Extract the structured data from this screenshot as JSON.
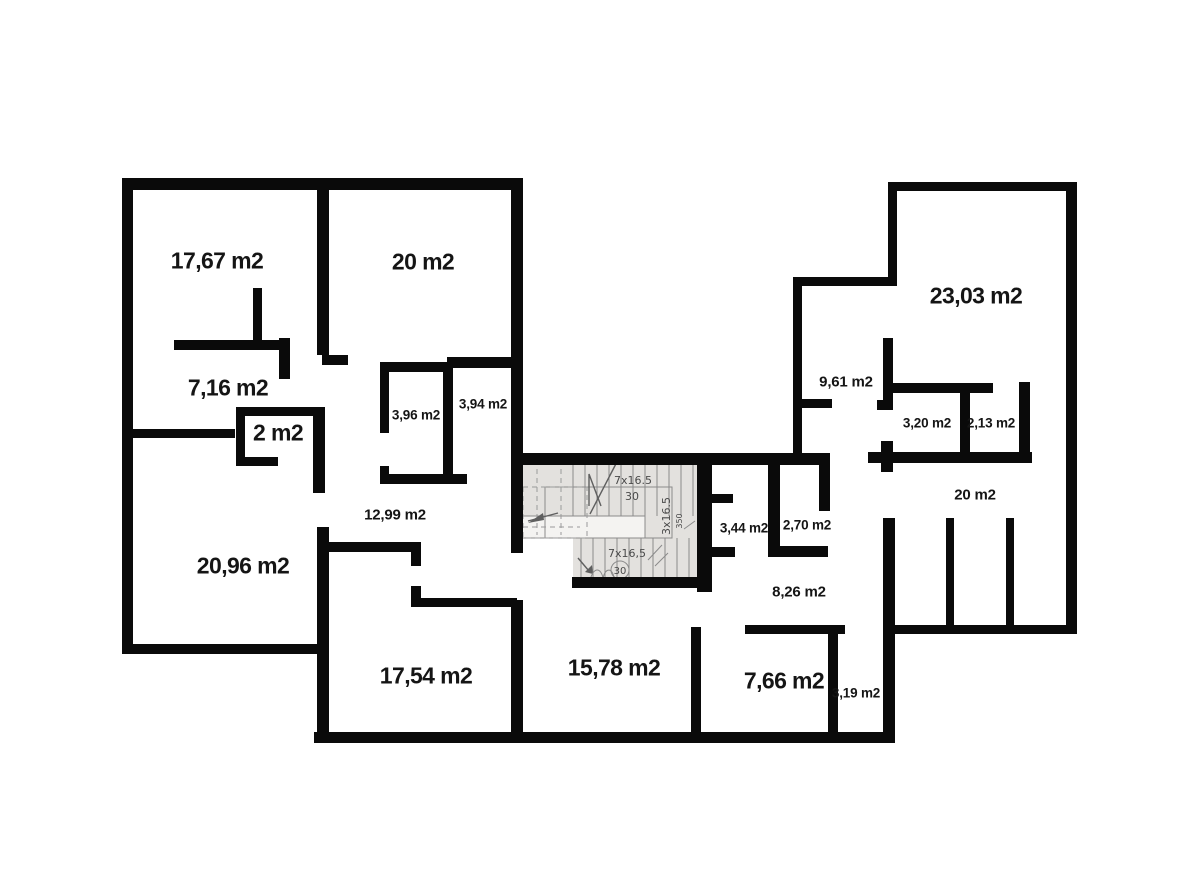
{
  "plan_title": "apartment-floor-plan",
  "colors": {
    "wall": "#0a0a0a",
    "background": "#ffffff",
    "stairwell_fill": "#e3e1de"
  },
  "rooms": [
    {
      "label": "17,67 m2"
    },
    {
      "label": "20 m2"
    },
    {
      "label": "7,16 m2"
    },
    {
      "label": "2 m2"
    },
    {
      "label": "3,96 m2"
    },
    {
      "label": "3,94 m2"
    },
    {
      "label": "12,99 m2"
    },
    {
      "label": "20,96 m2"
    },
    {
      "label": "17,54 m2"
    },
    {
      "label": "15,78 m2"
    },
    {
      "label": "3,44 m2"
    },
    {
      "label": "2,70 m2"
    },
    {
      "label": "8,26 m2"
    },
    {
      "label": "7,66 m2"
    },
    {
      "label": "3,19 m2"
    },
    {
      "label": "23,03 m2"
    },
    {
      "label": "9,61 m2"
    },
    {
      "label": "3,20 m2"
    },
    {
      "label": "2,13 m2"
    },
    {
      "label": "20 m2"
    }
  ],
  "stairs": {
    "up_steps": "7x16.5",
    "up_tread": "30",
    "side_steps": "3x16.5",
    "side_width": "350",
    "down_steps": "7x16,5",
    "down_tread": "30"
  }
}
